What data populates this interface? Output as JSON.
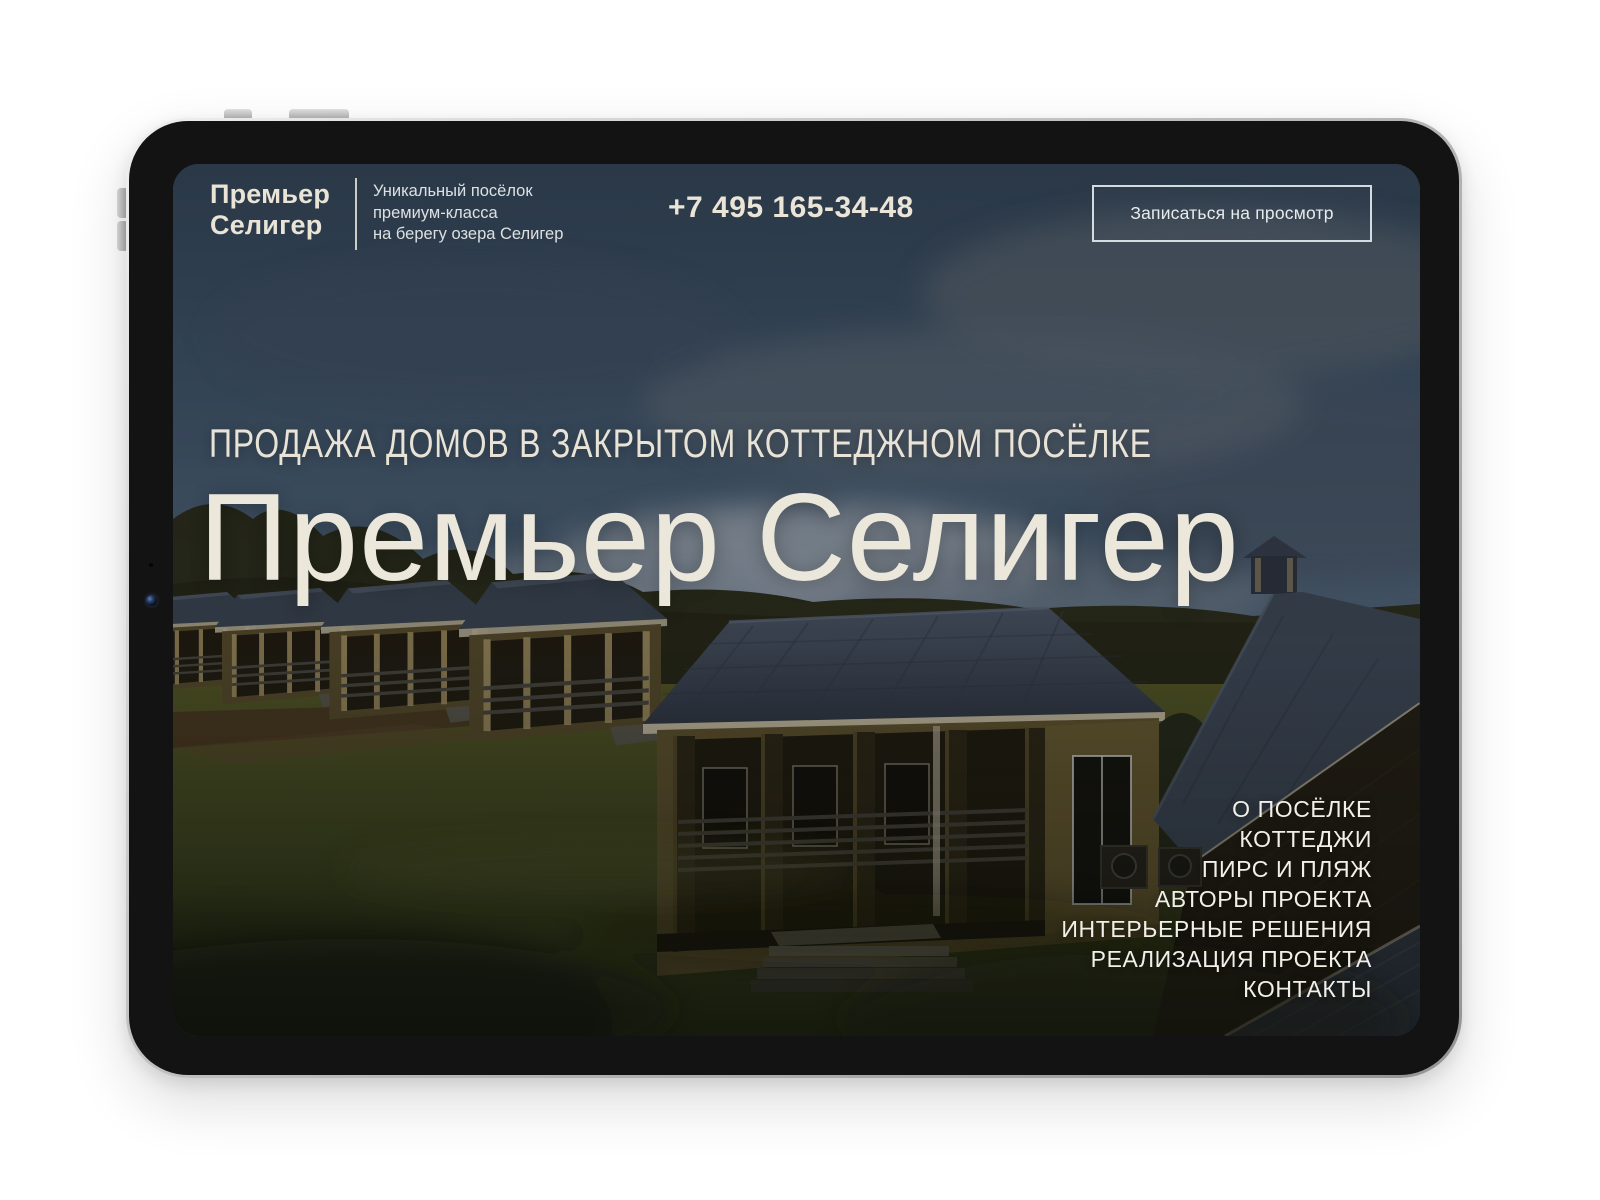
{
  "site": {
    "header": {
      "logo": {
        "line1": "Премьер",
        "line2": "Селигер"
      },
      "tagline": {
        "line1": "Уникальный посёлок",
        "line2": "премиум-класса",
        "line3": "на берегу озера Селигер"
      },
      "phone": "+7 495 165-34-48",
      "cta": "Записаться на просмотр"
    },
    "hero": {
      "kicker": "ПРОДАЖА ДОМОВ В ЗАКРЫТОМ КОТТЕДЖНОМ ПОСЁЛКЕ",
      "title": "Премьер Селигер"
    },
    "nav": {
      "items": [
        "О ПОСЁЛКЕ",
        "КОТТЕДЖИ",
        "ПИРС И ПЛЯЖ",
        "АВТОРЫ ПРОЕКТА",
        "ИНТЕРЬЕРНЫЕ РЕШЕНИЯ",
        "РЕАЛИЗАЦИЯ ПРОЕКТА",
        "КОНТАКТЫ"
      ]
    },
    "colors": {
      "text_cream": "#ece7db",
      "text_white": "#f2efe8",
      "sky": "#41566b",
      "lawn": "#3f4620",
      "bezel": "#131313",
      "cta_border": "#e2e9ee"
    }
  }
}
